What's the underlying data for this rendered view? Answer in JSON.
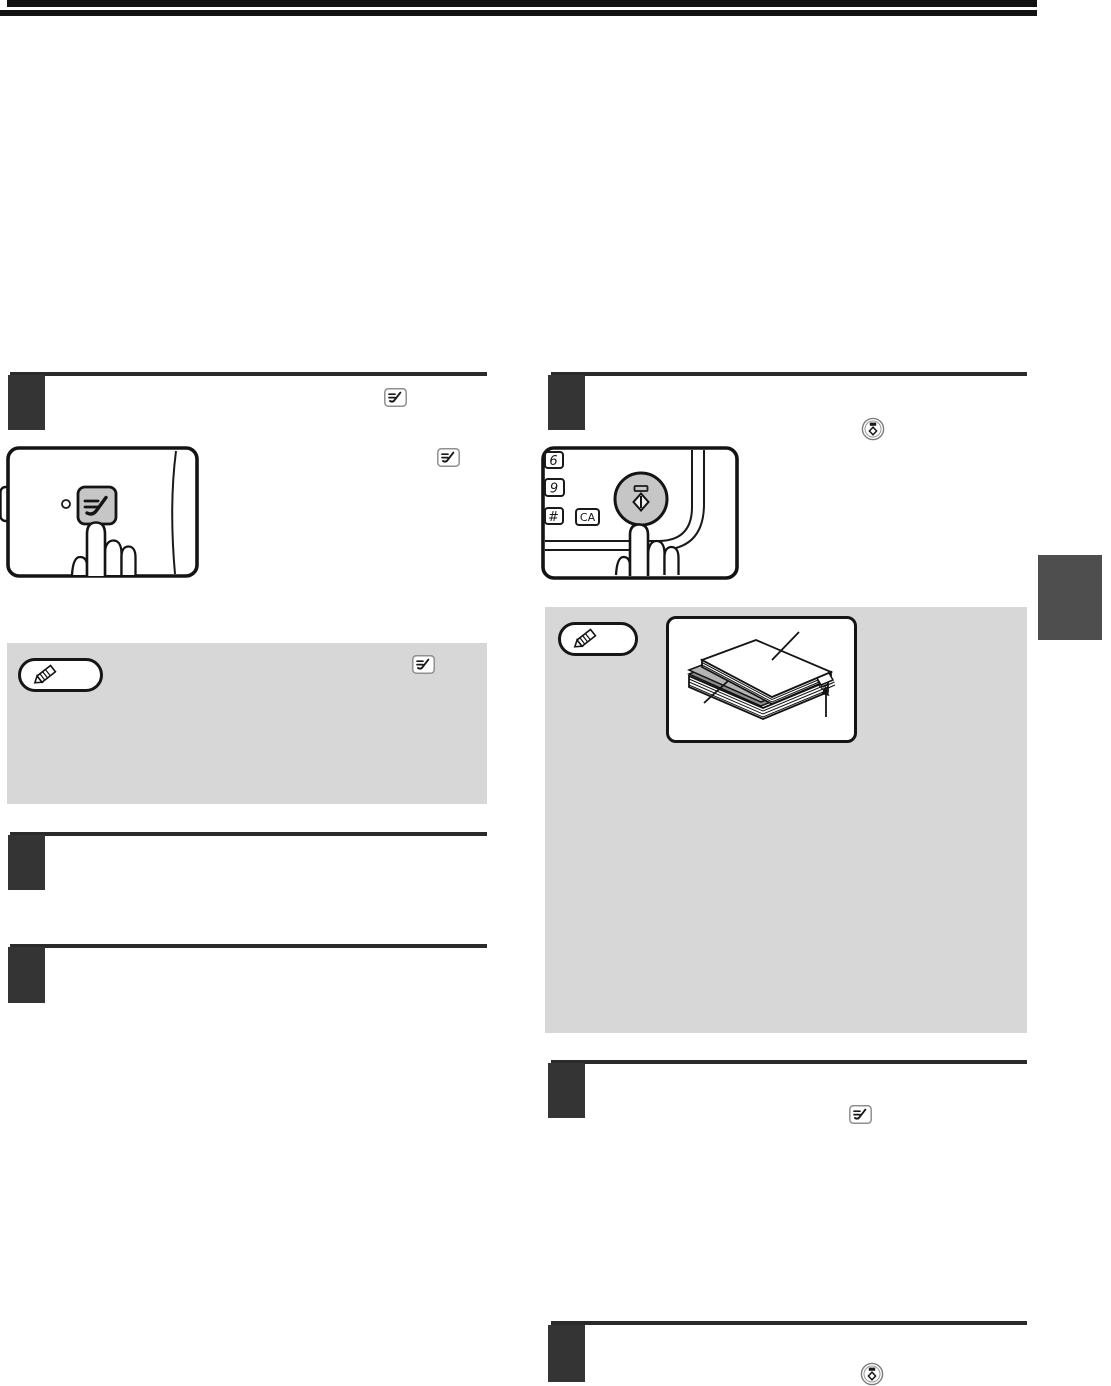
{
  "document": {
    "keypad": {
      "key_6": "6",
      "key_9": "9",
      "key_hash": "#",
      "key_ca": "CA"
    },
    "icons": {
      "tray_select_key": "small rounded key with feed/check symbol",
      "start_key": "circular start key with indicator bar and diamond",
      "note_badge": "pencil note badge",
      "pointing_hand": "finger pressing key"
    },
    "colors": {
      "page_bg": "#ffffff",
      "top_bar": "#121212",
      "section_rule": "#2b2b2b",
      "step_block": "#343434",
      "note_box_gray": "#d7d7d7",
      "key_gray": "#c6c6c6",
      "side_tab_gray": "#4e4e4e",
      "insert_sheet_gray": "#b4b4b4"
    }
  }
}
